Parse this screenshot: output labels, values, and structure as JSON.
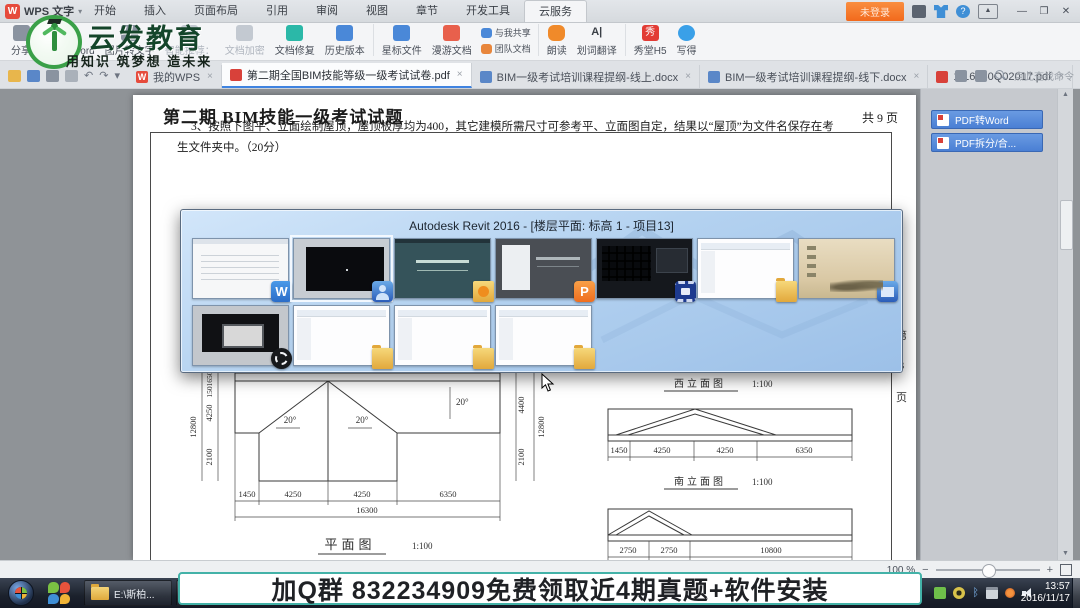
{
  "titlebar": {
    "app_name": "WPS 文字",
    "menu_tabs": [
      "开始",
      "插入",
      "页面布局",
      "引用",
      "审阅",
      "视图",
      "章节",
      "开发工具",
      "云服务"
    ],
    "active_menu_tab": "云服务",
    "login_button": "未登录"
  },
  "brand": {
    "name": "云发教育",
    "tagline": "用知识 筑梦想 造未来"
  },
  "ribbon": {
    "items": [
      {
        "label": "分享"
      },
      {
        "label": "PDF转Word"
      },
      {
        "label": "图片转文字"
      },
      {
        "label": "智能推荐："
      },
      {
        "label": "文档加密"
      },
      {
        "label": "文档修复"
      },
      {
        "label": "历史版本"
      },
      {
        "label": "星标文件"
      },
      {
        "label": "漫游文档"
      },
      {
        "label": "与我共享"
      },
      {
        "label": "团队文档"
      },
      {
        "label": "朗读"
      },
      {
        "label": "划词翻译"
      },
      {
        "label": "秀堂H5"
      },
      {
        "label": "写得"
      }
    ]
  },
  "doc_tabs": {
    "home_tab": "我的WPS",
    "tabs": [
      "第二期全国BIM技能等级一级考试试卷.pdf",
      "BIM一级考试培训课程提纲-线上.docx",
      "BIM一级考试培训课程提纲-线下.docx",
      "1-16060Q02017.pdf"
    ],
    "search_placeholder": "点此查找命令"
  },
  "page": {
    "title": "第二期 BIM技能一级考试试题",
    "page_count": "共 9 页",
    "question": "3、按照下图平、立面绘制屋顶，屋顶板厚均为400，其它建模所需尺寸可参考平、立面图自定，结果以“屋顶”为文件名保存在考生文件夹中。（20分）",
    "side_label": [
      "第",
      "3",
      "页"
    ],
    "drawings": {
      "plan": {
        "label": "平面图",
        "scale": "1:100",
        "bottom_dims": [
          "1450",
          "4250",
          "4250",
          "6350"
        ],
        "bottom_total": "16300",
        "left_total": "12800",
        "left_dims": [
          "1650",
          "150",
          "4250",
          "2100"
        ],
        "right_total": "12800",
        "right_dims": [
          "4400",
          "2100"
        ],
        "angles": [
          "20°",
          "20°",
          "20°"
        ]
      },
      "elev_west": {
        "label": "西立面图",
        "scale": "1:100",
        "dims": [
          "1450",
          "4250",
          "4250",
          "6350"
        ]
      },
      "elev_south": {
        "label": "南立面图",
        "scale": "1:100",
        "dims": [
          "2750",
          "2750",
          "10800"
        ]
      }
    }
  },
  "switcher": {
    "title": "Autodesk Revit 2016 - [楼层平面: 标高 1 - 项目13]",
    "windows": [
      {
        "name": "wps-writer-document"
      },
      {
        "name": "autodesk-revit-2016",
        "selected": true
      },
      {
        "name": "video-course-window"
      },
      {
        "name": "wps-presentation"
      },
      {
        "name": "video-editor"
      },
      {
        "name": "file-explorer-1"
      },
      {
        "name": "desktop"
      },
      {
        "name": "obs-studio"
      },
      {
        "name": "file-explorer-2"
      },
      {
        "name": "file-explorer-3"
      },
      {
        "name": "file-explorer-4"
      }
    ]
  },
  "right_panel": {
    "buttons": [
      "PDF转Word",
      "PDF拆分/合..."
    ]
  },
  "status_bar": {
    "zoom_level": "100 %"
  },
  "banner": {
    "text": "加Q群 832234909免费领取近4期真题+软件安装"
  },
  "taskbar": {
    "folder_button": "E:\\斯柏...",
    "time": "13:57",
    "date": "2016/11/17"
  },
  "icons": {
    "caret_down": "▾",
    "undo": "↶",
    "redo": "↷",
    "minimize": "—",
    "maximize": "❐",
    "close": "✕",
    "close_small": "×",
    "plus": "+",
    "scroll_up": "▲",
    "scroll_down": "▼",
    "zoom_out": "−",
    "zoom_in": "+",
    "wps_w": "W",
    "wpp_p": "P",
    "xiutang": "秀",
    "translate": "A|",
    "help": "?",
    "bluetooth": "ᛒ",
    "panel_up": "▲"
  }
}
